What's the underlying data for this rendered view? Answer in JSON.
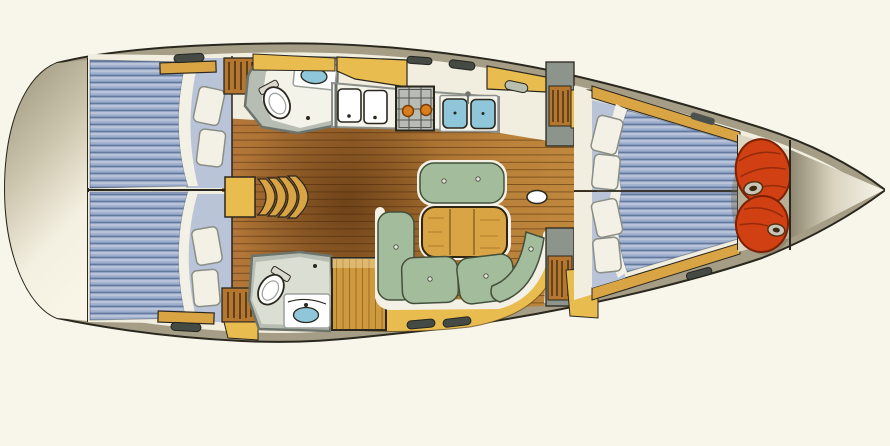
{
  "scene": {
    "subject": "sailboat-interior-floorplan",
    "view": "overhead-plan",
    "bow_direction": "right"
  },
  "colors": {
    "page_bg": "#f8f5ea",
    "line": "#2a271e",
    "deck_olive": "#a59d85",
    "deck_white": "#f1eee0",
    "wall_gray": "#6d746c",
    "fixture_gray": "#8d948b",
    "head_floor": "#b7bdb2",
    "counter_white": "#f4f3ea",
    "wood_light": "#c08a3e",
    "wood_mid": "#a26a2e",
    "wood_dark": "#7c4a1f",
    "berth_blue": "#9fb0ce",
    "berth_stripe": "#64799f",
    "berth_pale": "#b9c4d8",
    "pillow": "#f3f1e5",
    "cushion_green": "#a3bc9b",
    "cushion_edge": "#44503c",
    "table_oak": "#d9a544",
    "locker_yellow": "#e9bc4f",
    "locker_wood": "#b5772f",
    "stove_gray": "#b7bcb6",
    "burner_orange": "#d97d1f",
    "sink_blue": "#8fc6da",
    "sailbag_red": "#d04012",
    "sailbag_dark": "#7e2004",
    "bag_ring": "#c9c5b8",
    "hatch_dark": "#454a44"
  },
  "rooms": [
    {
      "name": "aft-deck",
      "features": []
    },
    {
      "name": "aft-cabin-port",
      "features": [
        "double-berth",
        "pillows",
        "shelf",
        "hanging-locker"
      ]
    },
    {
      "name": "aft-cabin-starboard",
      "features": [
        "double-berth",
        "pillows",
        "shelf",
        "hanging-locker"
      ]
    },
    {
      "name": "companionway-steps",
      "features": [
        "curved-steps"
      ]
    },
    {
      "name": "head-port",
      "features": [
        "toilet",
        "washbasin",
        "counter"
      ]
    },
    {
      "name": "head-starboard",
      "features": [
        "toilet",
        "washbasin",
        "counter"
      ]
    },
    {
      "name": "galley",
      "features": [
        "icebox-lids",
        "stove-two-burners",
        "double-sink",
        "lockers"
      ]
    },
    {
      "name": "saloon",
      "features": [
        "u-settee",
        "dining-table",
        "bench-seat",
        "mast-step"
      ]
    },
    {
      "name": "wardrobe-cabinet",
      "features": [
        "wood-cabinet"
      ]
    },
    {
      "name": "forward-cabin",
      "features": [
        "v-berth",
        "pillows",
        "shelves",
        "hanging-locker"
      ]
    },
    {
      "name": "sail-locker",
      "features": [
        "sail-bag",
        "sail-bag"
      ]
    },
    {
      "name": "bow",
      "features": []
    }
  ]
}
